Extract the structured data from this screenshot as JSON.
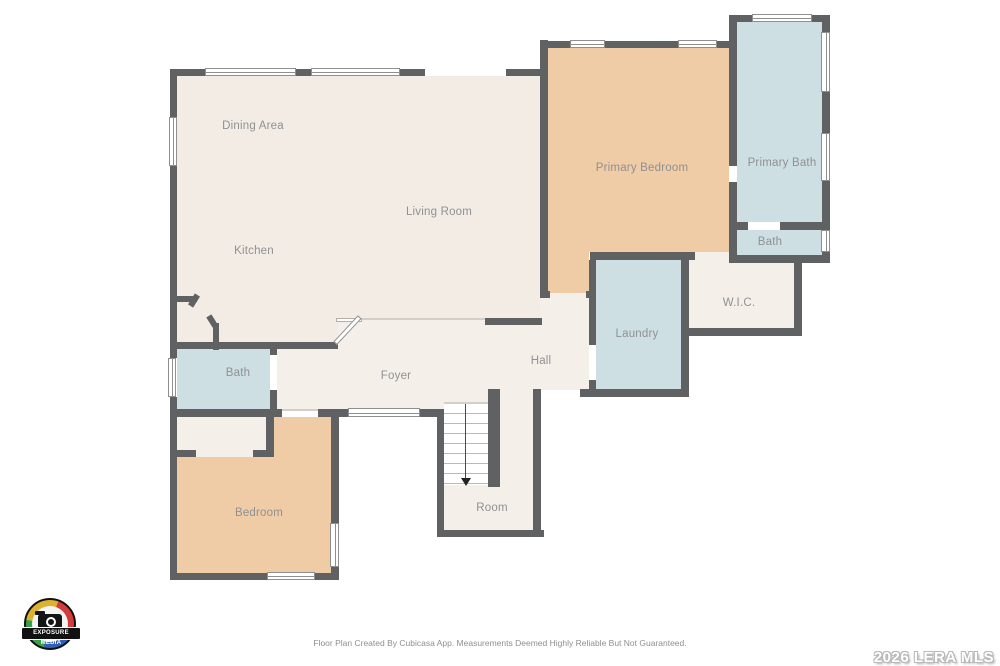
{
  "rooms": {
    "dining": {
      "label": "Dining Area"
    },
    "living": {
      "label": "Living Room"
    },
    "kitchen": {
      "label": "Kitchen"
    },
    "primary_bedroom": {
      "label": "Primary Bedroom"
    },
    "primary_bath": {
      "label": "Primary Bath"
    },
    "bath_upper": {
      "label": "Bath"
    },
    "wic": {
      "label": "W.I.C."
    },
    "laundry": {
      "label": "Laundry"
    },
    "hall": {
      "label": "Hall"
    },
    "foyer": {
      "label": "Foyer"
    },
    "bath_lower": {
      "label": "Bath"
    },
    "bedroom": {
      "label": "Bedroom"
    },
    "room": {
      "label": "Room"
    }
  },
  "footer": {
    "disclaimer": "Floor Plan Created By Cubicasa App. Measurements Deemed Highly Reliable But Not Guaranteed."
  },
  "watermark": {
    "text": "2026 LERA MLS"
  },
  "logo": {
    "text": "EXPOSURE MEDIA"
  },
  "palette": {
    "wall": "#5f6163",
    "room_beige": "#f3ece5",
    "room_beige_light": "#f5efe9",
    "room_tan": "#efcba6",
    "room_blue": "#cedfe3",
    "background": "#ffffff",
    "label": "#8f9193"
  }
}
